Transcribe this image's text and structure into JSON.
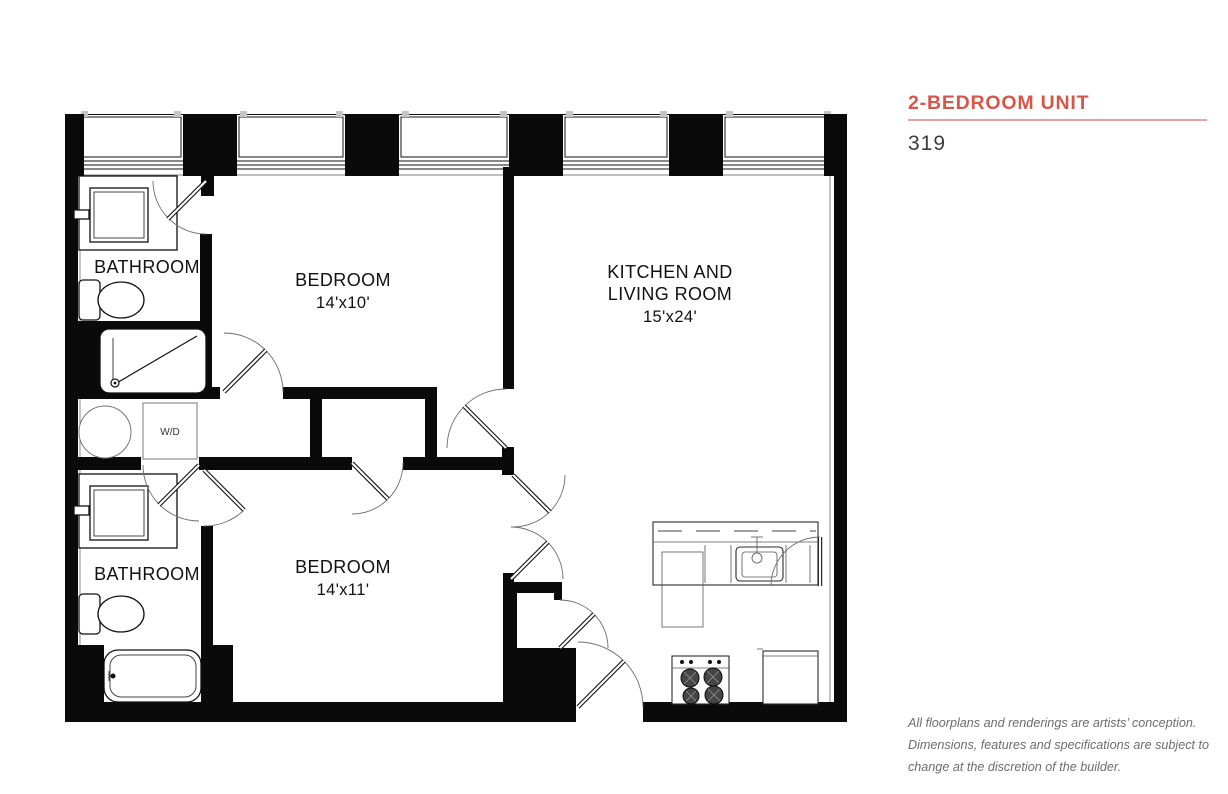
{
  "sidebar": {
    "title": "2-BEDROOM UNIT",
    "unit_number": "319",
    "accent_color": "#d7564a",
    "disclaimer": {
      "line1": "All floorplans and renderings are artists’ conception.",
      "line2": "Dimensions, features and specifications are subject to",
      "line3": "change at the discretion of the builder."
    }
  },
  "floorplan": {
    "rooms": {
      "bathroom1": {
        "label": "BATHROOM"
      },
      "bedroom1": {
        "label": "BEDROOM",
        "dims": "14'x10'"
      },
      "kitchen_living": {
        "line1": "KITCHEN AND",
        "line2": "LIVING ROOM",
        "dims": "15'x24'"
      },
      "bathroom2": {
        "label": "BATHROOM"
      },
      "bedroom2": {
        "label": "BEDROOM",
        "dims": "14'x11'"
      },
      "laundry": {
        "label": "W/D"
      }
    }
  }
}
